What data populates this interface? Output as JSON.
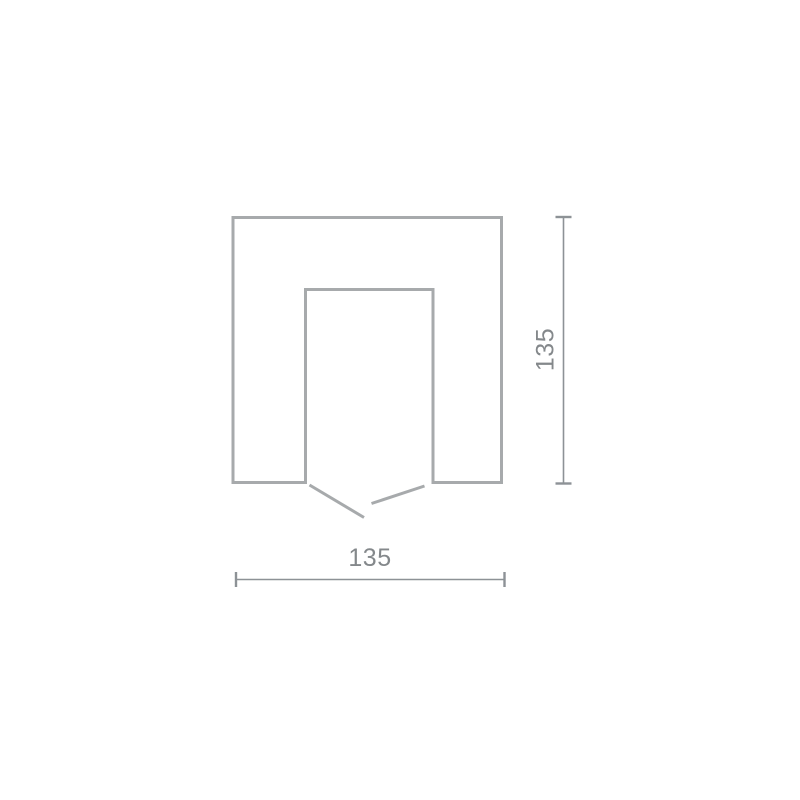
{
  "page": {
    "background": "#ffffff"
  },
  "diagram": {
    "type": "dimension-drawing",
    "width_dimension": {
      "label": "135"
    },
    "height_dimension": {
      "label": "135"
    },
    "colors": {
      "outline": "#a7aaac",
      "dimension_line": "#8d9296",
      "label_text": "#84888b"
    }
  }
}
